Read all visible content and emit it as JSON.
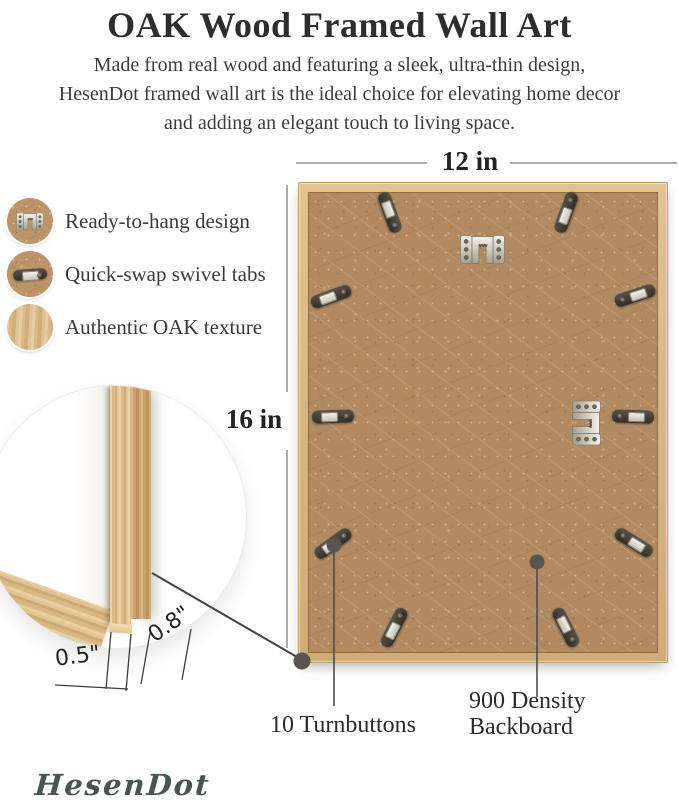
{
  "header": {
    "title": "OAK Wood Framed Wall Art",
    "description_lines": [
      "Made from real wood and featuring a sleek, ultra-thin design,",
      "HesenDot framed wall art is the ideal choice for elevating home decor",
      "and adding an elegant touch to living space."
    ]
  },
  "features": [
    {
      "icon": "sawtooth-hanger-icon",
      "label": "Ready-to-hang design"
    },
    {
      "icon": "swivel-tab-icon",
      "label": "Quick-swap swivel tabs"
    },
    {
      "icon": "oak-texture-icon",
      "label": "Authentic OAK texture"
    }
  ],
  "diagram": {
    "width_label": "12 in",
    "height_label": "16 in",
    "turnbutton_count": 10,
    "callouts": {
      "turnbuttons": "10 Turnbuttons",
      "backboard_line1": "900 Density",
      "backboard_line2": "Backboard"
    }
  },
  "detail_inset": {
    "face_width_label": "0.5\"",
    "depth_label": "0.8\""
  },
  "brand": {
    "logo": "HesenDot"
  },
  "colors": {
    "backboard": "#b28a62",
    "oak": "#dcb987",
    "metal_dark": "#3f3b34",
    "metal_light": "#d9d6cd",
    "dimension_line": "#8d8d8d",
    "callout_line": "#4e4a48",
    "text": "#2f2f2f",
    "logo": "#4a5550"
  }
}
